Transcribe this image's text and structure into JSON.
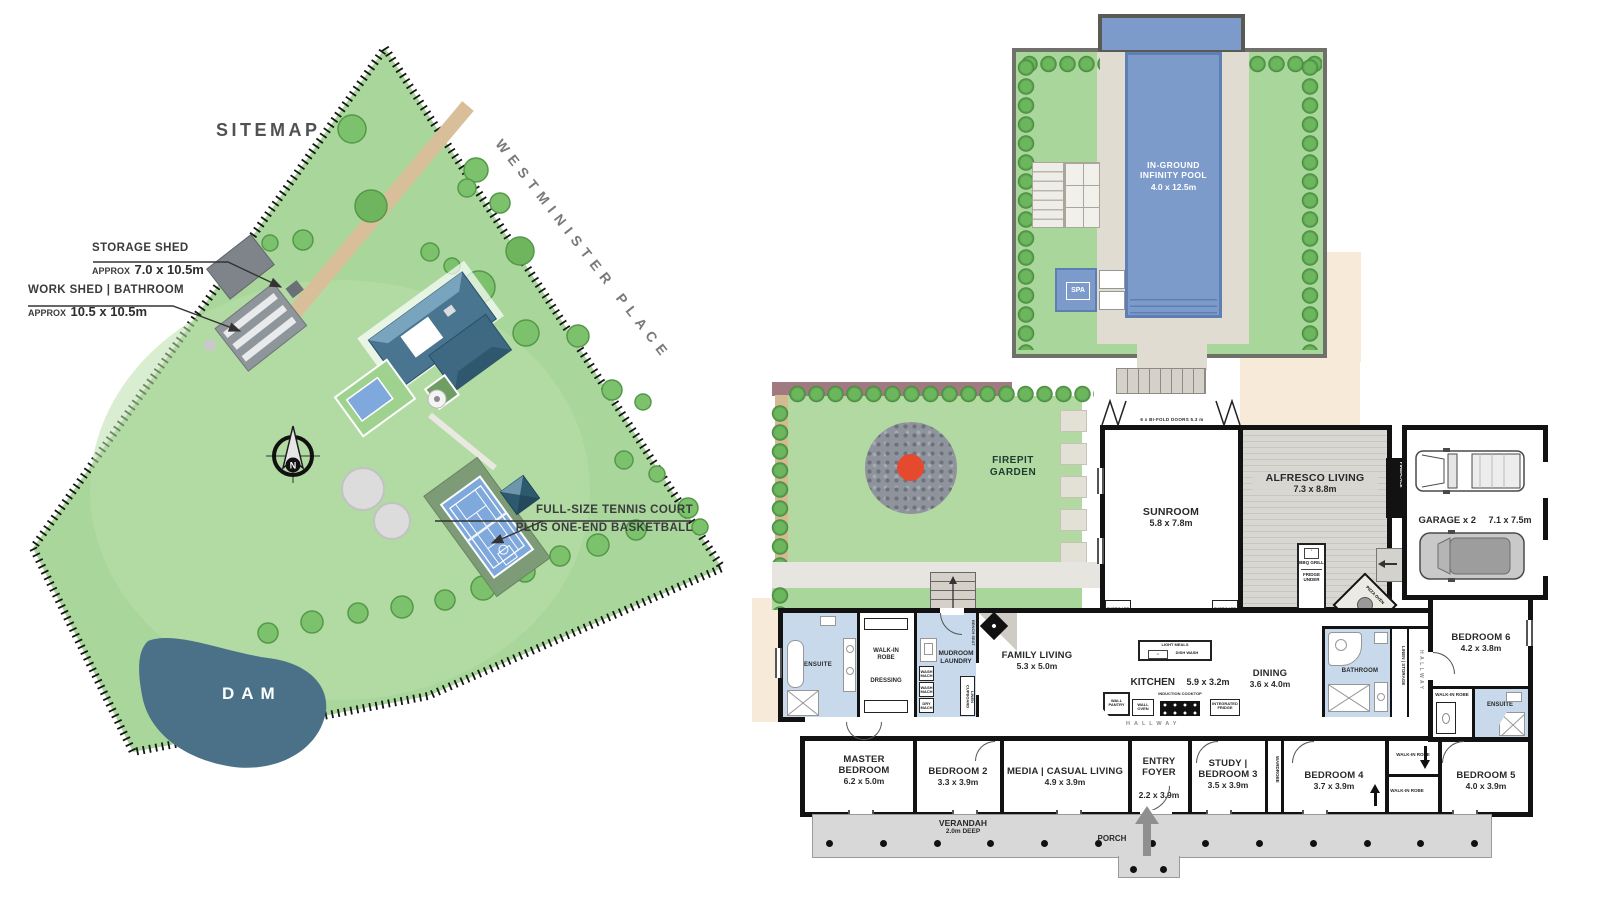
{
  "sitemap": {
    "title": "SITEMAP",
    "street_name": "WESTMINISTER PLACE",
    "dam": "DAM",
    "compass": "N",
    "storage_shed": {
      "title": "STORAGE SHED",
      "approx": "APPROX",
      "dims": "7.0 x 10.5m"
    },
    "work_shed": {
      "title": "WORK SHED | BATHROOM",
      "approx": "APPROX",
      "dims": "10.5 x 10.5m"
    },
    "tennis": {
      "line1": "FULL-SIZE TENNIS COURT",
      "line2": "PLUS ONE-END BASKETBALL"
    }
  },
  "floorplan": {
    "pool": {
      "name": "IN-GROUND INFINITY POOL",
      "dims": "4.0 x 12.5m"
    },
    "spa": "SPA",
    "firepit_garden": "FIREPIT GARDEN",
    "bifold_doors": "6 x BI-FOLD DOORS 5.3 m",
    "sunroom": {
      "name": "SUNROOM",
      "dims": "5.8 x 7.8m"
    },
    "alfresco": {
      "name": "ALFRESCO LIVING",
      "dims": "7.3 x 8.8m"
    },
    "fireplace_alfresco": "FIREPLACE",
    "bbq_grill": "BBQ GRILL",
    "fridge_under": "FRIDGE UNDER",
    "pizza_oven": "PIZZA OVEN",
    "garage": {
      "name": "GARAGE x 2",
      "dims": "7.1 x 7.5m"
    },
    "ensuite_master": "ENSUITE",
    "walkin_master": "WALK-IN ROBE",
    "dressing": "DRESSING",
    "mudroom": "MUDROOM LAUNDRY",
    "wash_mach_1": "WASH MACH",
    "wash_mach_2": "WASH MACH",
    "dry_mach": "DRY MACH",
    "linen_cupboard": "LINEN CUPBOARD",
    "bench_seat": "BENCH SEAT",
    "family_living": {
      "name": "FAMILY LIVING",
      "dims": "5.3 x 5.0m"
    },
    "kitchen": {
      "name": "KITCHEN",
      "dims": "5.9 x 3.2m"
    },
    "light_meals": "LIGHT MEALS",
    "dish_wash": "DISH WASH",
    "induction_cooktop": "INDUCTION COOKTOP",
    "wall_pantry": "WALL PANTRY",
    "wall_oven": "WALL OVEN",
    "integrated_fridge": "INTEGRATED FRIDGE",
    "cupboard_left": "CUPBOARD",
    "cupboard_right": "CUPBOARD",
    "dining": {
      "name": "DINING",
      "dims": "3.6 x 4.0m"
    },
    "bathroom": "BATHROOM",
    "linen_storage": "LINEN | STORAGE",
    "hallway_main": "HALLWAY",
    "hallway_side": "HALLWAY",
    "bedroom6": {
      "name": "BEDROOM 6",
      "dims": "4.2 x 3.8m"
    },
    "walkin_bed6": "WALK-IN ROBE",
    "ensuite_bed6": "ENSUITE",
    "master_bedroom": {
      "name": "MASTER BEDROOM",
      "dims": "6.2 x 5.0m"
    },
    "bedroom2": {
      "name": "BEDROOM 2",
      "dims": "3.3 x 3.9m"
    },
    "media": {
      "name": "MEDIA | CASUAL LIVING",
      "dims": "4.9 x 3.9m"
    },
    "entry_foyer": {
      "name": "ENTRY FOYER",
      "dims": "2.2 x 3.9m"
    },
    "study": {
      "name": "STUDY | BEDROOM 3",
      "dims": "3.5 x 3.9m"
    },
    "wardrobe": "WARDROBE",
    "bedroom4": {
      "name": "BEDROOM 4",
      "dims": "3.7 x 3.9m"
    },
    "walkin_a": "WALK-IN ROBE",
    "walkin_b": "WALK-IN ROBE",
    "bedroom5": {
      "name": "BEDROOM 5",
      "dims": "4.0 x 3.9m"
    },
    "verandah": {
      "name": "VERANDAH",
      "dims": "2.0m DEEP"
    },
    "porch": "PORCH"
  },
  "colors": {
    "land_green": "#a9d69b",
    "lawn_light": "#b9dfa9",
    "dam_blue": "#4a7187",
    "pool_blue": "#7d9bca",
    "wet_blue": "#c7d9ea",
    "court_blue": "#7fa8dc",
    "roof_blue": "#4a7590",
    "fire_red": "#e54a2e",
    "stone_gray": "#8f939c",
    "verandah_gray": "#d8d8d8",
    "cream": "#f8ead9",
    "maroon_wall": "#a07a80",
    "driveway_tan": "#d8bf99",
    "wall_black": "#121212"
  }
}
